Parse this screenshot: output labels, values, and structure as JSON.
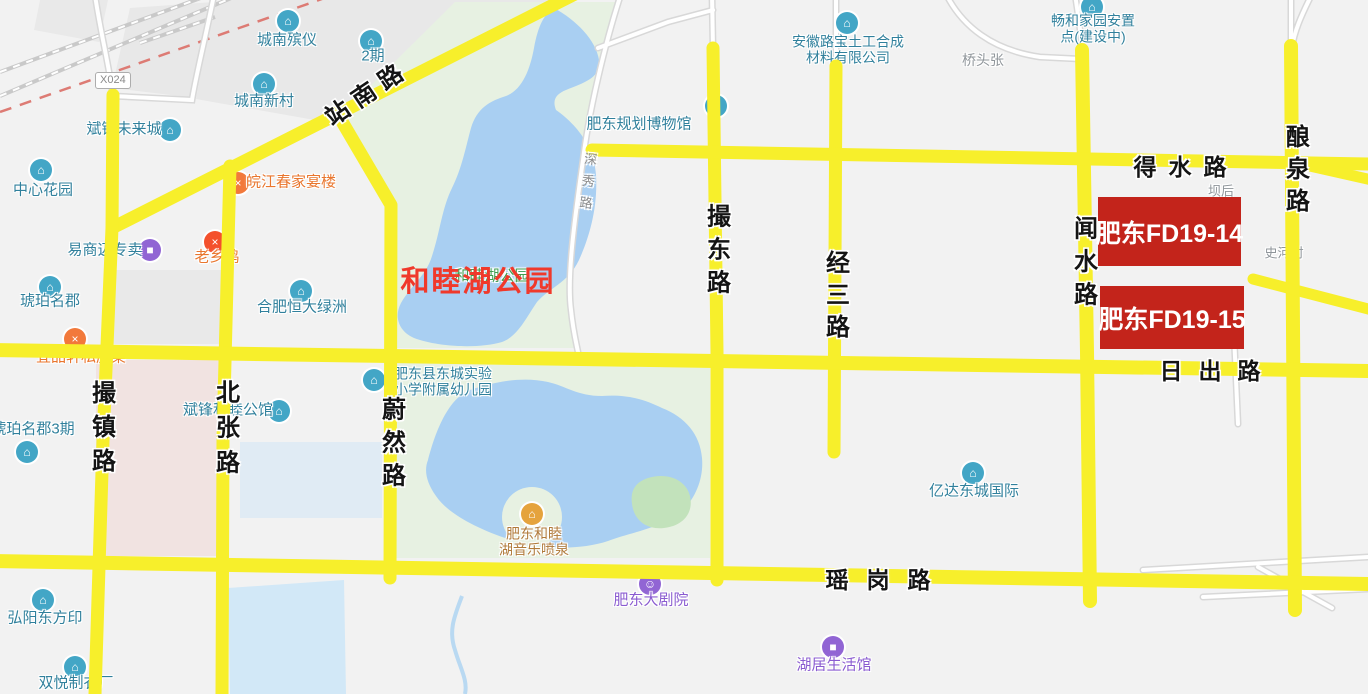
{
  "map": {
    "colors": {
      "background": "#f2f2f2",
      "road_yellow": "#f7ef2b",
      "park_green": "#e7f1e2",
      "water_blue": "#a9cff2",
      "island_green": "#c2e2bb",
      "block_gray": "#e8e8e8",
      "block_pink": "#f1e3e1",
      "block_blue": "#e0ebf4",
      "annotation_red": "#c3241b",
      "annotation_text_red": "#f0392b",
      "teal": "#30809c",
      "orange": "#e9762e",
      "purple": "#8a5bd0",
      "gray": "#8f959a",
      "brown": "#b07a3a",
      "green": "#3f9e4f",
      "icon_teal": "#43a6c6",
      "icon_purple": "#9165d4",
      "icon_orange": "#f2793b",
      "icon_red": "#f4502c",
      "icon_amber": "#e5a33d"
    },
    "road_sign": {
      "code": "X024"
    }
  },
  "annotations": {
    "parcels": [
      {
        "label": "肥东FD19-14",
        "x": 1098,
        "y": 197,
        "w": 143,
        "h": 69
      },
      {
        "label": "肥东FD19-15",
        "x": 1100,
        "y": 286,
        "w": 144,
        "h": 63
      }
    ],
    "park_highlight": {
      "label": "和睦湖公园",
      "x": 478,
      "y": 279
    }
  },
  "road_labels": [
    {
      "name": "zhannan-road-label",
      "text": "站南路",
      "x": 366,
      "y": 91,
      "mode": "rotated",
      "rotate": -34,
      "size": 24,
      "spacing": 8
    },
    {
      "name": "deshui-road-label",
      "text": "得水路",
      "x": 1186,
      "y": 165,
      "mode": "h",
      "size": 23,
      "spacing": 12
    },
    {
      "name": "richu-road-label",
      "text": "日出路",
      "x": 1218,
      "y": 369,
      "mode": "h",
      "size": 23,
      "spacing": 16
    },
    {
      "name": "yaogang-road-label",
      "text": "瑶岗路",
      "x": 887,
      "y": 578,
      "mode": "h",
      "size": 23,
      "spacing": 18
    },
    {
      "name": "cuozhen-road-label",
      "text": "撮镇路",
      "x": 101,
      "y": 431,
      "mode": "v",
      "size": 24,
      "spacing": 10
    },
    {
      "name": "beizhang-road-label",
      "text": "北张路",
      "x": 225,
      "y": 432,
      "mode": "v",
      "size": 24,
      "spacing": 11
    },
    {
      "name": "weiran-road-label",
      "text": "蔚然路",
      "x": 391,
      "y": 446,
      "mode": "v",
      "size": 24,
      "spacing": 9
    },
    {
      "name": "cuodong-road-label",
      "text": "撮东路",
      "x": 716,
      "y": 253,
      "mode": "v",
      "size": 24,
      "spacing": 9
    },
    {
      "name": "jingsan-road-label",
      "text": "经三路",
      "x": 835,
      "y": 298,
      "mode": "v",
      "size": 24,
      "spacing": 8
    },
    {
      "name": "wenshui-road-label",
      "text": "闻水路",
      "x": 1083,
      "y": 265,
      "mode": "v",
      "size": 24,
      "spacing": 9
    },
    {
      "name": "niangquan-road-label",
      "text": "酿泉路",
      "x": 1295,
      "y": 172,
      "mode": "v",
      "size": 24,
      "spacing": 8
    },
    {
      "name": "shenxiu-road-label",
      "text": "深秀路",
      "x": 587,
      "y": 185,
      "mode": "v",
      "size": 13,
      "spacing": 9,
      "color": "#8c8c8c",
      "weight": "normal",
      "rotate": 6
    }
  ],
  "pois": [
    {
      "name": "chengnan-binyi",
      "icon": {
        "kind": "building-icon",
        "glyph": "⌂",
        "bg": "icon_teal",
        "x": 288,
        "y": 21
      },
      "label": {
        "lines": [
          "城南殡仪"
        ],
        "x": 287,
        "y": 41,
        "color": "teal",
        "size": 15
      }
    },
    {
      "name": "erqi",
      "icon": {
        "kind": "building-icon",
        "glyph": "⌂",
        "bg": "icon_teal",
        "x": 371,
        "y": 41
      },
      "label": {
        "lines": [
          "2期"
        ],
        "x": 373,
        "y": 57,
        "color": "teal",
        "size": 15
      }
    },
    {
      "name": "chengnan-xincun",
      "icon": {
        "kind": "building-icon",
        "glyph": "⌂",
        "bg": "icon_teal",
        "x": 264,
        "y": 84
      },
      "label": {
        "lines": [
          "城南新村"
        ],
        "x": 264,
        "y": 102,
        "color": "teal",
        "size": 15
      }
    },
    {
      "name": "binfeng-weilaicheng",
      "icon": {
        "kind": "building-icon",
        "glyph": "⌂",
        "bg": "icon_teal",
        "x": 170,
        "y": 130
      },
      "label": {
        "lines": [
          "斌锋未来城"
        ],
        "x": 124,
        "y": 130,
        "color": "teal",
        "size": 15
      }
    },
    {
      "name": "zhongxin-huayuan",
      "icon": {
        "kind": "building-icon",
        "glyph": "⌂",
        "bg": "icon_teal",
        "x": 41,
        "y": 170
      },
      "label": {
        "lines": [
          "中心花园"
        ],
        "x": 43,
        "y": 191,
        "color": "teal",
        "size": 15
      }
    },
    {
      "name": "yishangmai",
      "icon": {
        "kind": "shopping-bag-icon",
        "glyph": "■",
        "bg": "icon_purple",
        "x": 150,
        "y": 250
      },
      "label": {
        "lines": [
          "易商迈专卖"
        ],
        "x": 105,
        "y": 251,
        "color": "teal",
        "size": 15
      }
    },
    {
      "name": "laoxiangji",
      "icon": {
        "kind": "restaurant-icon",
        "glyph": "×",
        "bg": "icon_red",
        "x": 215,
        "y": 242
      },
      "label": {
        "lines": [
          "老乡鸡"
        ],
        "x": 217,
        "y": 258,
        "color": "orange",
        "size": 15
      }
    },
    {
      "name": "wanjiangchun",
      "icon": {
        "kind": "restaurant-icon",
        "glyph": "×",
        "bg": "icon_orange",
        "x": 238,
        "y": 183
      },
      "label": {
        "lines": [
          "皖江春家宴楼"
        ],
        "x": 291,
        "y": 183,
        "color": "orange",
        "size": 15
      }
    },
    {
      "name": "hupo-mingjun",
      "icon": {
        "kind": "building-icon",
        "glyph": "⌂",
        "bg": "icon_teal",
        "x": 50,
        "y": 287
      },
      "label": {
        "lines": [
          "琥珀名郡"
        ],
        "x": 50,
        "y": 302,
        "color": "teal",
        "size": 15
      }
    },
    {
      "name": "hengda-lvzhou",
      "icon": {
        "kind": "building-icon",
        "glyph": "⌂",
        "bg": "icon_teal",
        "x": 301,
        "y": 291
      },
      "label": {
        "lines": [
          "合肥恒大绿洲"
        ],
        "x": 302,
        "y": 308,
        "color": "teal",
        "size": 15
      }
    },
    {
      "name": "yipinxuan",
      "icon": {
        "kind": "restaurant-icon",
        "glyph": "×",
        "bg": "icon_orange",
        "x": 75,
        "y": 339
      },
      "label": {
        "lines": [
          "宜品轩私房菜"
        ],
        "x": 81,
        "y": 358,
        "color": "orange",
        "size": 15
      }
    },
    {
      "name": "hupo-mingjun-3qi",
      "icon": {
        "kind": "building-icon",
        "glyph": "⌂",
        "bg": "icon_teal",
        "x": 27,
        "y": 452
      },
      "label": {
        "lines": [
          "琥珀名郡3期"
        ],
        "x": 33,
        "y": 430,
        "color": "teal",
        "size": 15
      }
    },
    {
      "name": "binfeng-hemu-gongguan",
      "icon": {
        "kind": "building-icon",
        "glyph": "⌂",
        "bg": "icon_teal",
        "x": 279,
        "y": 411
      },
      "label": {
        "lines": [
          "斌锋和睦公馆"
        ],
        "x": 228,
        "y": 411,
        "color": "teal",
        "size": 15
      }
    },
    {
      "name": "dongcheng-shiyan-xiaoxue",
      "icon": {
        "kind": "school-icon",
        "glyph": "⌂",
        "bg": "icon_teal",
        "x": 374,
        "y": 380
      },
      "label": {
        "lines": [
          "肥东县东城实验",
          "小学附属幼儿园"
        ],
        "x": 443,
        "y": 382,
        "color": "teal",
        "size": 14
      }
    },
    {
      "name": "guihua-bowuguan",
      "icon": {
        "kind": "museum-icon",
        "glyph": "⌂",
        "bg": "icon_teal",
        "x": 716,
        "y": 106
      },
      "label": {
        "lines": [
          "肥东规划博物馆"
        ],
        "x": 639,
        "y": 125,
        "color": "teal",
        "size": 15
      }
    },
    {
      "name": "anhui-lubao",
      "icon": {
        "kind": "company-icon",
        "glyph": "⌂",
        "bg": "icon_teal",
        "x": 847,
        "y": 23
      },
      "label": {
        "lines": [
          "安徽路宝土工合成",
          "材料有限公司"
        ],
        "x": 848,
        "y": 50,
        "color": "teal",
        "size": 14
      }
    },
    {
      "name": "changhe-jiayuan",
      "icon": {
        "kind": "building-icon",
        "glyph": "⌂",
        "bg": "icon_teal",
        "x": 1092,
        "y": 7
      },
      "label": {
        "lines": [
          "畅和家园安置",
          "点(建设中)"
        ],
        "x": 1093,
        "y": 29,
        "color": "teal",
        "size": 14
      }
    },
    {
      "name": "yida-dongcheng",
      "icon": {
        "kind": "building-icon",
        "glyph": "⌂",
        "bg": "icon_teal",
        "x": 973,
        "y": 473
      },
      "label": {
        "lines": [
          "亿达东城国际"
        ],
        "x": 974,
        "y": 492,
        "color": "teal",
        "size": 15
      }
    },
    {
      "name": "hemu-penquan",
      "icon": {
        "kind": "fountain-icon",
        "glyph": "⌂",
        "bg": "icon_amber",
        "x": 532,
        "y": 514
      },
      "label": {
        "lines": [
          "肥东和睦",
          "湖音乐喷泉"
        ],
        "x": 534,
        "y": 542,
        "color": "brown",
        "size": 14
      }
    },
    {
      "name": "feidong-dajuyuan",
      "icon": {
        "kind": "theater-icon",
        "glyph": "☺",
        "bg": "icon_purple",
        "x": 650,
        "y": 584
      },
      "label": {
        "lines": [
          "肥东大剧院"
        ],
        "x": 651,
        "y": 601,
        "color": "purple",
        "size": 15
      }
    },
    {
      "name": "huju-shenghuoguan",
      "icon": {
        "kind": "shopping-bag-icon",
        "glyph": "■",
        "bg": "icon_purple",
        "x": 833,
        "y": 647
      },
      "label": {
        "lines": [
          "湖居生活馆"
        ],
        "x": 834,
        "y": 666,
        "color": "purple",
        "size": 15
      }
    },
    {
      "name": "hongyang-dongfangyin",
      "icon": {
        "kind": "building-icon",
        "glyph": "⌂",
        "bg": "icon_teal",
        "x": 43,
        "y": 600
      },
      "label": {
        "lines": [
          "弘阳东方印"
        ],
        "x": 45,
        "y": 619,
        "color": "teal",
        "size": 15
      }
    },
    {
      "name": "shuangyue-zhiyichang",
      "icon": {
        "kind": "factory-icon",
        "glyph": "⌂",
        "bg": "icon_teal",
        "x": 75,
        "y": 667
      },
      "label": {
        "lines": [
          "双悦制衣厂"
        ],
        "x": 76,
        "y": 684,
        "color": "teal",
        "size": 15
      }
    }
  ],
  "places": [
    {
      "name": "qiaotouzhang",
      "text": "桥头张",
      "x": 983,
      "y": 61,
      "color": "gray",
      "size": 14
    },
    {
      "name": "bahou",
      "text": "坝后",
      "x": 1221,
      "y": 192,
      "color": "gray",
      "size": 13
    },
    {
      "name": "shihecun",
      "text": "史河村",
      "x": 1284,
      "y": 254,
      "color": "gray",
      "size": 13
    },
    {
      "name": "hemuhu-park-green-label",
      "text": "和睦湖公园",
      "x": 492,
      "y": 277,
      "color": "green",
      "size": 15
    }
  ]
}
